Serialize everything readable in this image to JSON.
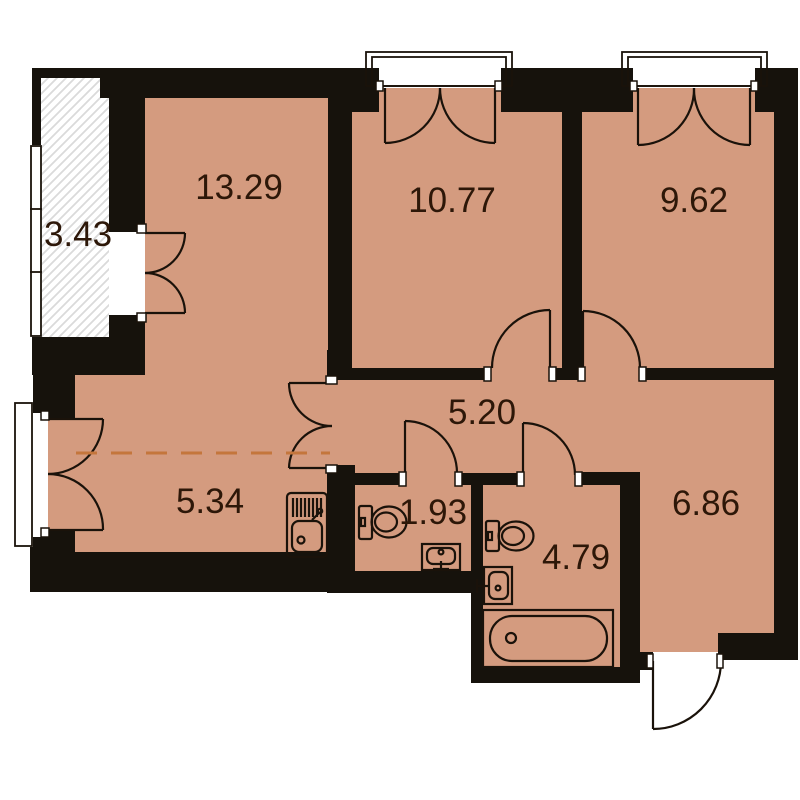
{
  "plan": {
    "type": "apartment-floor-plan",
    "rooms": [
      {
        "id": "balcony",
        "area": "3.43"
      },
      {
        "id": "living-room",
        "area": "13.29"
      },
      {
        "id": "bedroom-left",
        "area": "10.77"
      },
      {
        "id": "bedroom-right",
        "area": "9.62"
      },
      {
        "id": "corridor",
        "area": "5.20"
      },
      {
        "id": "kitchen-zone",
        "area": "5.34"
      },
      {
        "id": "wc",
        "area": "1.93"
      },
      {
        "id": "bathroom",
        "area": "4.79"
      },
      {
        "id": "entry-hall",
        "area": "6.86"
      }
    ],
    "fixtures": [
      "kitchen-sink-icon",
      "wc-toilet-icon",
      "wc-washbasin-icon",
      "bathroom-toilet-icon",
      "bathroom-washbasin-icon",
      "bathtub-icon"
    ],
    "colors": {
      "floor": "#D49B7F",
      "walls": "#16120C",
      "lines": "#1A120A",
      "labels": "#2D1708",
      "zone_divider": "#C4763C",
      "balcony_hatch": "#DADADA"
    }
  }
}
